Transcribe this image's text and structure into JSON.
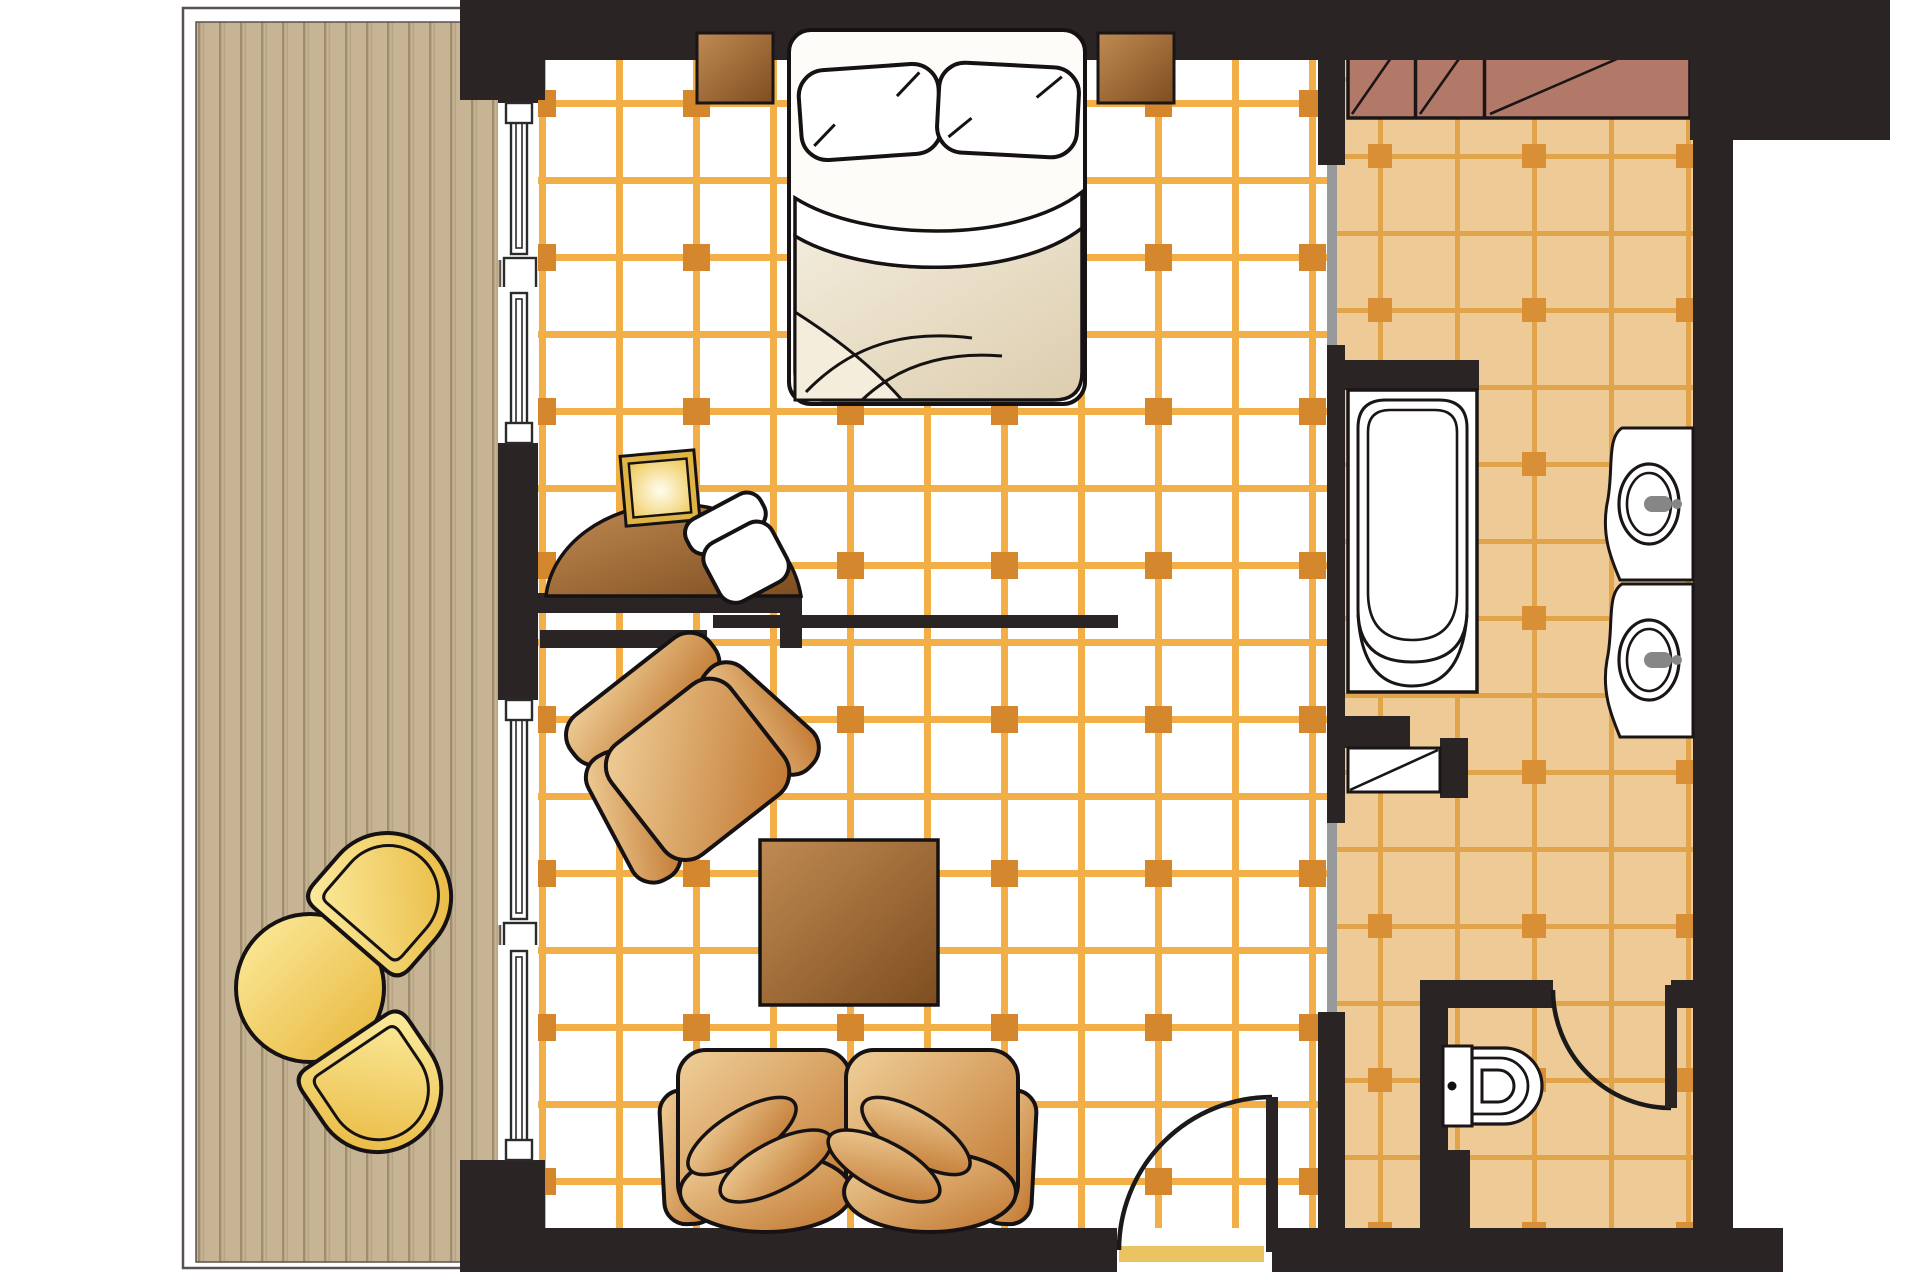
{
  "diagram": {
    "type": "hotel-suite-floor-plan",
    "view": "top-down",
    "rooms": [
      "balcony-terrace",
      "bedroom",
      "living-area",
      "bathroom-hallway",
      "wc-compartment"
    ],
    "furniture": [
      "double-bed",
      "pillow-left",
      "pillow-right",
      "nightstand-left",
      "nightstand-right",
      "desk",
      "desk-lamp",
      "desk-stool",
      "armchair",
      "coffee-table",
      "sofa-two-seat",
      "balcony-round-table",
      "balcony-chair-upper",
      "balcony-chair-lower",
      "wardrobe-closet"
    ],
    "fixtures": [
      "bathtub",
      "washbasin-upper",
      "washbasin-lower",
      "toilet",
      "linen-shelf",
      "entry-door",
      "wc-door",
      "sliding-door-panel",
      "window-left-1",
      "window-left-2",
      "window-left-3",
      "window-left-4"
    ]
  },
  "colors": {
    "wall": "#2a2425",
    "outline": "#1a1516",
    "room_floor": "#ffffff",
    "room_grid_line": "#f2ae47",
    "room_grid_dot": "#d4872c",
    "bath_floor": "#eeca96",
    "bath_grid_line": "#e2a44a",
    "bath_grid_dot": "#d88f36",
    "deck": "#c7b494",
    "deck_groove": "#9f8e6e",
    "deck_groove_light": "#b6a584",
    "closet": "#b37968",
    "partition_glass": "#98999b",
    "door_threshold": "#eac362",
    "door_swing": "#1a1a1a",
    "faucet": "#868686",
    "fixture_white": "#ffffff",
    "tan_light": "#f0d09a",
    "tan_dark": "#c0752e",
    "brown_light": "#c08a52",
    "brown_dark": "#7e4e20",
    "yellow_light": "#fceda0",
    "yellow_dark": "#e7b437",
    "glow_center": "#fffdf0",
    "glow_edge": "#eec54e",
    "duvet_light": "#f3ecdc",
    "duvet_dark": "#dccdae",
    "bed_white": "#fdfcf8"
  }
}
